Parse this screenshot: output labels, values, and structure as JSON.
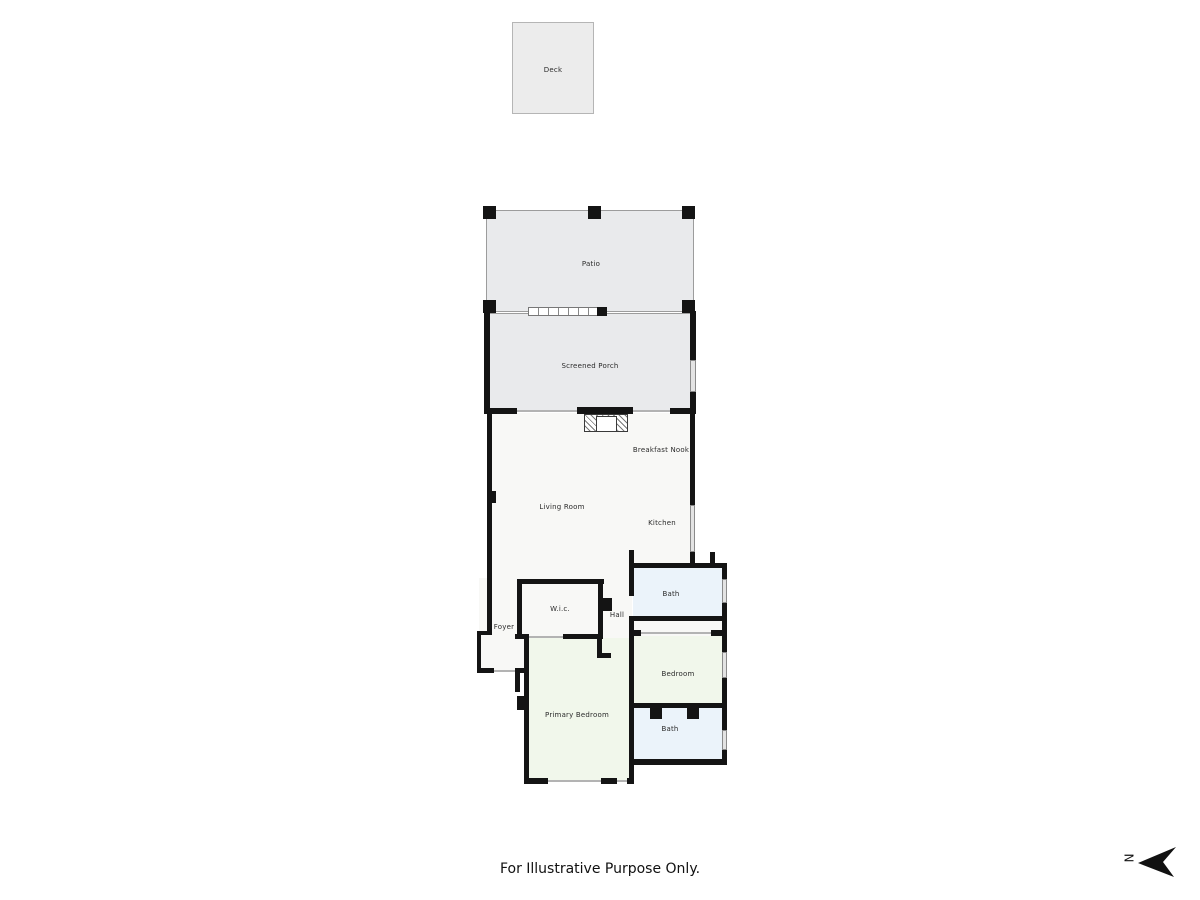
{
  "title": "Floor plan",
  "palette": {
    "outdoor_fill": "#e9eaec",
    "deck_fill": "#ececec",
    "interior_fill": "#f8f8f6",
    "bath_fill": "#ebf3fa",
    "bedroom_fill": "#f1f7eb",
    "wall_color": "#141414"
  },
  "rooms": [
    {
      "label": "Deck"
    },
    {
      "label": "Patio"
    },
    {
      "label": "Screened Porch"
    },
    {
      "label": "Breakfast Nook"
    },
    {
      "label": "Living Room"
    },
    {
      "label": "Kitchen"
    },
    {
      "label": "Bath"
    },
    {
      "label": "Hall"
    },
    {
      "label": "W.i.c."
    },
    {
      "label": "Foyer"
    },
    {
      "label": "Bedroom"
    },
    {
      "label": "Primary Bedroom"
    },
    {
      "label": "Bath"
    }
  ],
  "footer": {
    "disclaimer": "For Illustrative Purpose Only."
  },
  "compass": {
    "label": "N"
  }
}
